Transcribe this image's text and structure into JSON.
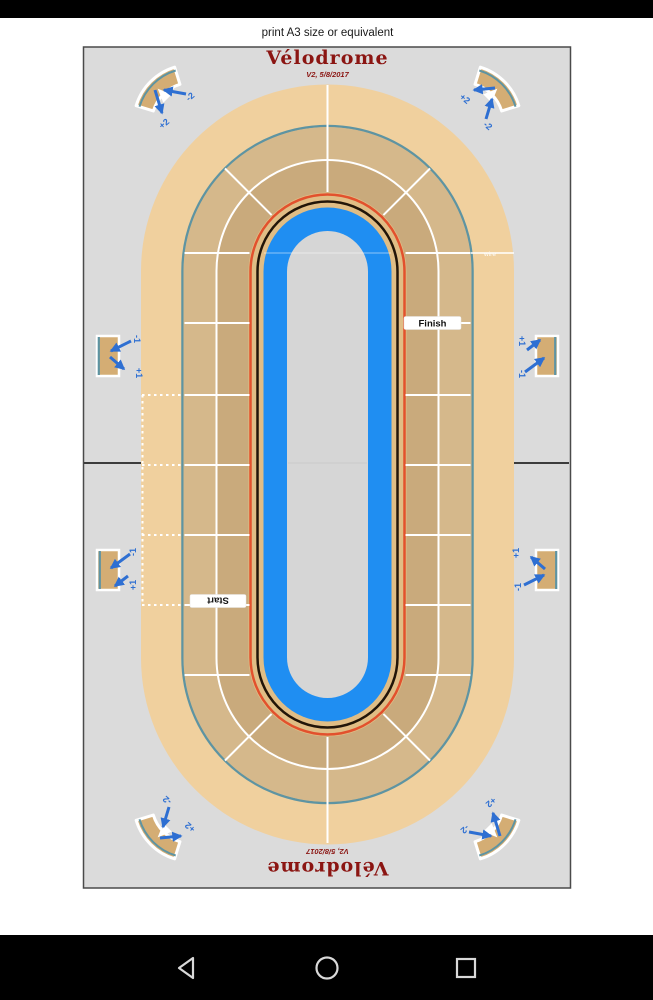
{
  "page": {
    "print_note": "print A3 size or equivalent"
  },
  "board": {
    "title": "Vélodrome",
    "version": "V2, 5/8/2017",
    "finish_label": "Finish",
    "start_label": "Start",
    "wire_label": "wire",
    "corner_bonus": "+2",
    "corner_penalty": "-2",
    "side_bonus": "+1",
    "side_penalty": "-1"
  },
  "nav": {
    "back_icon": "back-triangle",
    "home_icon": "home-circle",
    "recents_icon": "recents-square"
  },
  "colors": {
    "board_bg": "#dbdbdb",
    "sand": "#f0d09e",
    "lane_outer": "#d5b88b",
    "lane_inner": "#c9aa7c",
    "apron": "#e0bd85",
    "blue_band": "#1f8ef2",
    "infield": "#d6d6d6",
    "red_line": "#e2512d",
    "black_line": "#221508",
    "teal_line": "#5e94a2",
    "piece_fill": "#d4ad74",
    "arrow_blue": "#2e6fd2",
    "title_red": "#8b1512",
    "divider_dark": "#3c3c3c",
    "nav_icon": "#d9d9d9"
  }
}
